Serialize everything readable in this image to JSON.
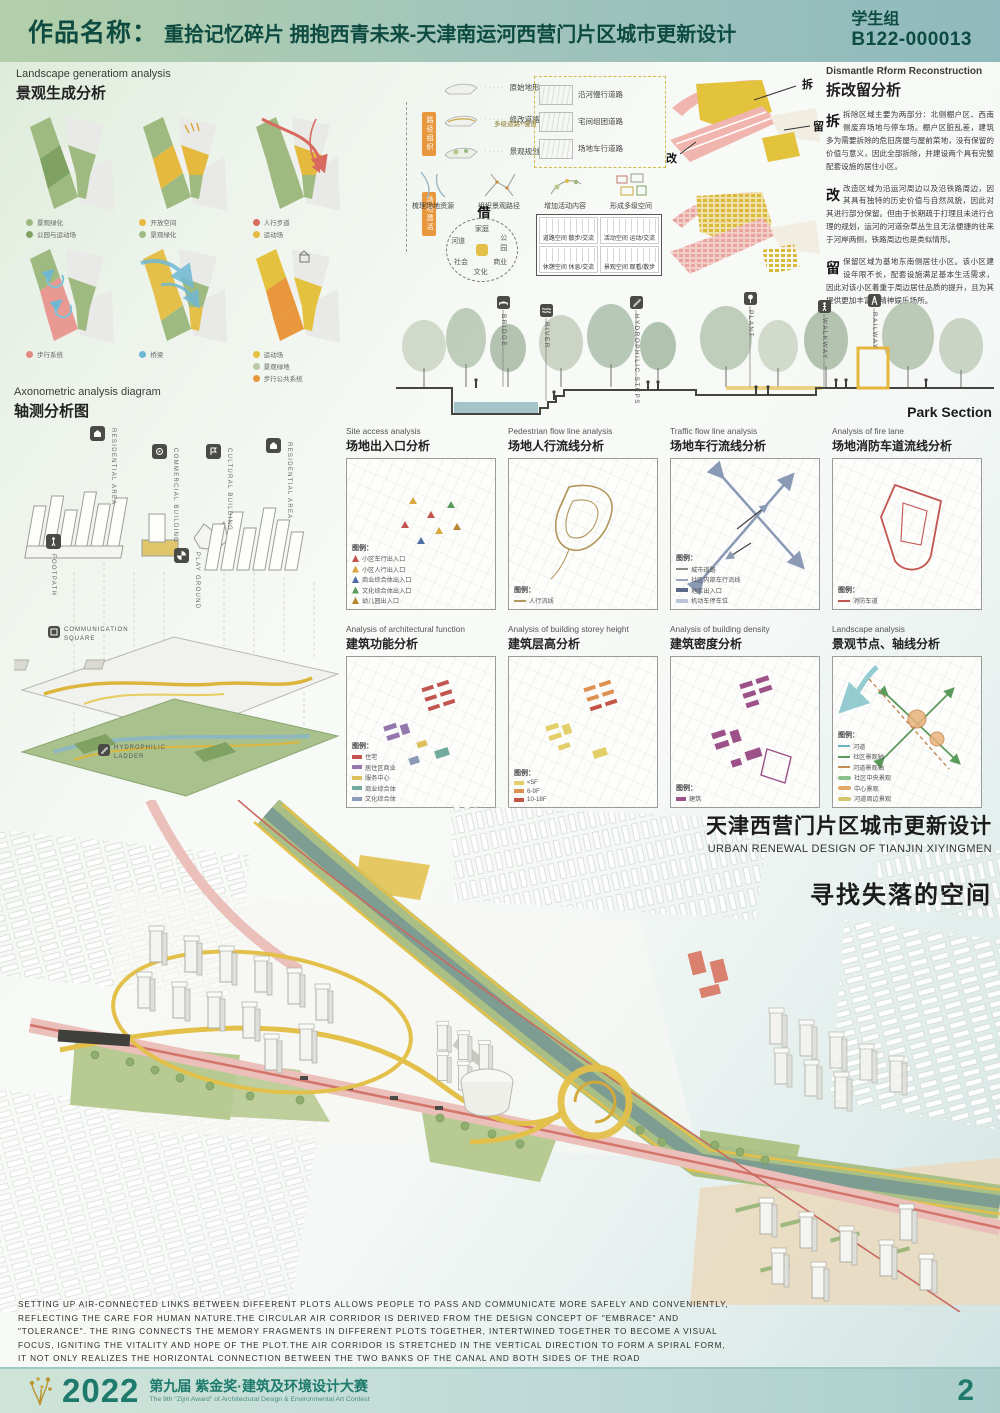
{
  "header": {
    "label": "作品名称：",
    "title": "重拾记忆碎片 拥抱西青未来-天津南运河西营门片区城市更新设计",
    "group": "学生组",
    "code": "B122-000013"
  },
  "landscape": {
    "title_en": "Landscape generatiom analysis",
    "title_cn": "景观生成分析",
    "diagrams": [
      {
        "legend": [
          {
            "label": "景观绿化",
            "color": "#9fba80"
          },
          {
            "label": "公园与运动场",
            "color": "#7fa263"
          }
        ]
      },
      {
        "legend": [
          {
            "label": "开放空间",
            "color": "#e4b93e"
          },
          {
            "label": "景观绿化",
            "color": "#9fba80"
          }
        ]
      },
      {
        "legend": [
          {
            "label": "人行步道",
            "color": "#d96a5f"
          },
          {
            "label": "运动场",
            "color": "#e4b93e"
          }
        ]
      },
      {
        "legend": [
          {
            "label": "步行系统",
            "color": "#e08a80"
          }
        ]
      },
      {
        "legend": [
          {
            "label": "桥梁",
            "color": "#6fb8d4"
          }
        ]
      },
      {
        "legend": [
          {
            "label": "运动场",
            "color": "#e4c13e"
          },
          {
            "label": "景观绿地",
            "color": "#b9c9a8"
          },
          {
            "label": "步行公共系统",
            "color": "#e8973c"
          }
        ]
      }
    ]
  },
  "generation": {
    "steps": [
      "原始地形",
      "修改道路",
      "景观规划"
    ],
    "note": "多级道路+慢道",
    "roads": [
      "沿河慢行道路",
      "宅间组团道路",
      "场地车行道路"
    ],
    "tags": [
      "路径组织",
      "场地激活"
    ],
    "process": [
      "梳理场地资源",
      "组织景观路径",
      "增加活动内容",
      "形成多级空间"
    ],
    "circle": {
      "center_char": "借",
      "nodes": [
        "家庭",
        "公园",
        "商业",
        "文化",
        "社会",
        "河道"
      ]
    },
    "matrix": [
      "道路空间 散步/交流",
      "活动空间 运动/交流",
      "休憩空间 休息/交流",
      "景观空间 观看/散步"
    ]
  },
  "dismantle": {
    "title_en": "Dismantle  Rform Reconstruction",
    "title_cn": "拆改留分析",
    "map_labels": [
      "拆",
      "改",
      "留"
    ],
    "paragraphs": [
      {
        "lead": "拆",
        "text": "拆除区域主要为两部分：北侧棚户区、西南侧废弃场地与停车场。棚户区脏乱差，建筑多为需要拆除的危旧房屋与屋前菜地，没有保留的价值与意义，因此全部拆除，并建设两个具有完整配套设施的居住小区。"
      },
      {
        "lead": "改",
        "text": "改造区域为沿运河周边以及沿铁路周边，因其具有独特的历史价值与自然风貌，因此对其进行部分保留。但由于长期疏于打理且未进行合理的规划，运河的河道杂草丛生且无法便捷的往来于河岸两侧，铁路周边也是类似情形。"
      },
      {
        "lead": "留",
        "text": "保留区域为基地东南侧居住小区。该小区建设年限不长，配套设施满足基本生活需求，因此对该小区着重于周边居住品质的提升，且为其提供更加丰富的精神娱乐场所。"
      }
    ]
  },
  "park": {
    "labels": [
      "BRIDGE",
      "RIVER",
      "HYDROPHILIC STEPS",
      "PLANT",
      "WALKWAY",
      "RAILWAY"
    ],
    "caption": "Park Section"
  },
  "axon": {
    "title_en": "Axonometric analysis diagram",
    "title_cn": "轴测分析图",
    "labels": [
      "RESIDENTIAL AREA",
      "COMMERCIAL BUILDING",
      "CULTURAL BUILDING",
      "RESIDENTIAL AREA",
      "FOOTPATH",
      "PLAY GROUND",
      "COMMUNICATION SQUARE",
      "HYDROPHILIC LADDER"
    ]
  },
  "grid": {
    "legend_label": "图例：",
    "panels": [
      {
        "title_en": "Site access analysis",
        "title_cn": "场地出入口分析",
        "legend": [
          {
            "label": "小区车行出入口",
            "color": "#c2554f"
          },
          {
            "label": "小区人行出入口",
            "color": "#d9a83c"
          },
          {
            "label": "商业综合体出入口",
            "color": "#4f6ea8"
          },
          {
            "label": "文化综合体出入口",
            "color": "#5d9a5d"
          },
          {
            "label": "幼儿园出入口",
            "color": "#b8862e"
          }
        ]
      },
      {
        "title_en": "Pedestrian flow line analysis",
        "title_cn": "场地人行流线分析",
        "legend": [
          {
            "label": "人行流线",
            "color": "#b2965a"
          }
        ]
      },
      {
        "title_en": "Traffic flow line analysis",
        "title_cn": "场地车行流线分析",
        "legend": [
          {
            "label": "城市道路",
            "color": "#8a8a86"
          },
          {
            "label": "社区内部车行流线",
            "color": "#9aa7bd"
          },
          {
            "label": "地库出入口",
            "color": "#5a6b8c"
          },
          {
            "label": "机动车停车位",
            "color": "#b9c4d6"
          }
        ]
      },
      {
        "title_en": "Analysis of fire lane",
        "title_cn": "场地消防车道流线分析",
        "legend": [
          {
            "label": "消防车道",
            "color": "#c2554f"
          }
        ]
      },
      {
        "title_en": "Analysis of architectural function",
        "title_cn": "建筑功能分析",
        "legend": [
          {
            "label": "住宅",
            "color": "#c2554f"
          },
          {
            "label": "居住区商业",
            "color": "#9478ad"
          },
          {
            "label": "服务中心",
            "color": "#ddc05e"
          },
          {
            "label": "商业综合体",
            "color": "#72ab9d"
          },
          {
            "label": "文化综合体",
            "color": "#8c9ab5"
          }
        ]
      },
      {
        "title_en": "Analysis of building storey height",
        "title_cn": "建筑层高分析",
        "legend": [
          {
            "label": "<5F",
            "color": "#e3cf6a"
          },
          {
            "label": "6-9F",
            "color": "#dd9150"
          },
          {
            "label": "10-18F",
            "color": "#c25545"
          }
        ]
      },
      {
        "title_en": "Analysis of building density",
        "title_cn": "建筑密度分析",
        "legend": [
          {
            "label": "建筑",
            "color": "#9c5288"
          }
        ]
      },
      {
        "title_en": "Landscape analysis",
        "title_cn": "景观节点、轴线分析",
        "legend": [
          {
            "label": "河道",
            "color": "#6ab4c4"
          },
          {
            "label": "社区景观轴",
            "color": "#5a9a5a"
          },
          {
            "label": "河道景观轴",
            "color": "#c28a54"
          },
          {
            "label": "社区中央景观",
            "color": "#8cc08c"
          },
          {
            "label": "中心景观",
            "color": "#e0a86a"
          },
          {
            "label": "河道周边景观",
            "color": "#d6c46e"
          }
        ]
      }
    ]
  },
  "project": {
    "title_cn": "天津西营门片区城市更新设计",
    "title_en": "URBAN RENEWAL DESIGN OF TIANJIN XIYINGMEN",
    "slogan": "寻找失落的空间"
  },
  "description": {
    "lines": [
      "SETTING UP AIR-CONNECTED LINKS BETWEEN DIFFERENT PLOTS ALLOWS PEOPLE TO PASS AND COMMUNICATE MORE SAFELY AND CONVENIENTLY,",
      "REFLECTING THE CARE FOR HUMAN NATURE.THE CIRCULAR AIR CORRIDOR IS DERIVED FROM THE DESIGN CONCEPT OF \"EMBRACE\" AND",
      "\"TOLERANCE\".  THE RING CONNECTS THE MEMORY FRAGMENTS IN DIFFERENT PLOTS TOGETHER, INTERTWINED TOGETHER TO BECOME A VISUAL",
      "FOCUS, IGNITING THE VITALITY AND HOPE OF THE PLOT.THE AIR CORRIDOR IS STRETCHED IN THE VERTICAL DIRECTION TO FORM A SPIRAL FORM,",
      "IT NOT ONLY REALIZES THE HORIZONTAL CONNECTION BETWEEN THE TWO BANKS OF THE CANAL AND BOTH SIDES OF THE ROAD"
    ]
  },
  "footer": {
    "year": "2022",
    "title_cn": "第九届 紫金奖·建筑及环境设计大赛",
    "title_en": "The 9th \"Zijin Award\" of Architectural Design & Environmental Art Contest",
    "page": "2"
  },
  "colors": {
    "header_text": "#0d4b41",
    "accent_gold": "#b9952f",
    "footer_teal": "#1d7a6c",
    "canal": "#7d9c92",
    "path_yellow": "#e3c049",
    "road_pink": "#ecc0ba"
  }
}
